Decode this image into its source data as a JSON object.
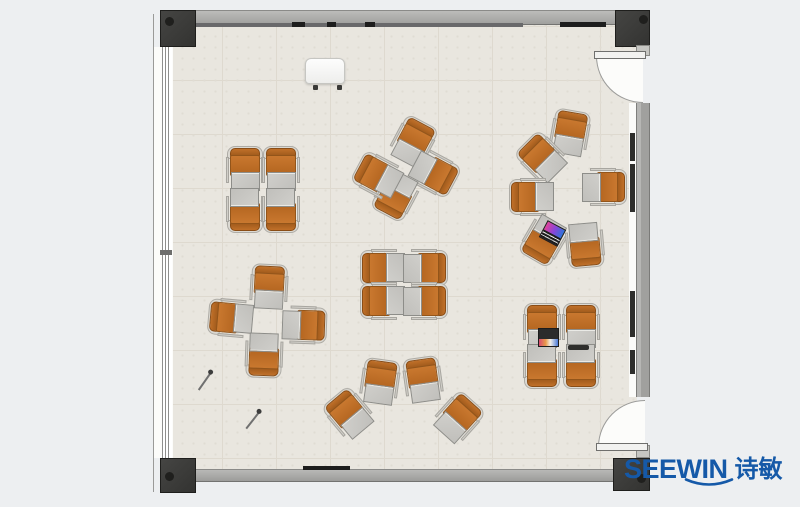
{
  "brand": {
    "name": "SEEWIN",
    "cjk": "诗敏"
  },
  "palette": {
    "brand": "#1559a8",
    "chair": "#c9782f",
    "chair-hi": "#c07029",
    "chair-dark": "#9e591b",
    "desk": "#d0cfcb",
    "wall": "#a6a6a4",
    "column": "#3a3a38",
    "floor": "#e9e6df"
  },
  "plan": {
    "columns": [
      {
        "x": 160,
        "y": 10,
        "w": 36,
        "h": 37,
        "dot": [
          4,
          6
        ]
      },
      {
        "x": 615,
        "y": 10,
        "w": 35,
        "h": 37,
        "dot": [
          23,
          4
        ]
      },
      {
        "x": 160,
        "y": 458,
        "w": 36,
        "h": 35,
        "dot": [
          4,
          13
        ]
      },
      {
        "x": 613,
        "y": 458,
        "w": 37,
        "h": 33,
        "dot": [
          23,
          15
        ]
      }
    ],
    "rwall_pieces": [
      {
        "y": 45,
        "h": 11
      },
      {
        "y": 445,
        "h": 13
      }
    ],
    "wall_boards": [
      {
        "y": 133,
        "h": 28
      },
      {
        "y": 164,
        "h": 48
      },
      {
        "y": 291,
        "h": 46
      },
      {
        "y": 350,
        "h": 24
      }
    ],
    "top_wall_marks": [
      {
        "x": 292,
        "w": 13
      },
      {
        "x": 327,
        "w": 9
      },
      {
        "x": 365,
        "w": 10
      },
      {
        "x": 560,
        "w": 46
      }
    ],
    "bottom_wall_marks": [
      {
        "x": 303,
        "w": 47
      }
    ],
    "doors": [
      {
        "corner": "bl",
        "x": 596,
        "y": 56,
        "size": 47,
        "leaf": [
          594,
          51,
          52,
          8
        ]
      },
      {
        "corner": "tl",
        "x": 598,
        "y": 400,
        "size": 47,
        "leaf": [
          596,
          443,
          52,
          8
        ]
      }
    ],
    "units": [
      {
        "x": 245,
        "y": 169,
        "r": 0
      },
      {
        "x": 281,
        "y": 169,
        "r": 0
      },
      {
        "x": 245,
        "y": 210,
        "r": 180
      },
      {
        "x": 281,
        "y": 210,
        "r": 180
      },
      {
        "x": 413,
        "y": 142,
        "r": 28
      },
      {
        "x": 434,
        "y": 173,
        "r": 118
      },
      {
        "x": 396,
        "y": 195,
        "r": 208
      },
      {
        "x": 378,
        "y": 176,
        "r": 298
      },
      {
        "x": 570,
        "y": 133,
        "r": 10
      },
      {
        "x": 542,
        "y": 158,
        "r": -45
      },
      {
        "x": 532,
        "y": 197,
        "r": -90
      },
      {
        "x": 604,
        "y": 187,
        "r": 90
      },
      {
        "x": 544,
        "y": 240,
        "r": 210
      },
      {
        "x": 585,
        "y": 245,
        "r": 175
      },
      {
        "x": 383,
        "y": 268,
        "r": -90
      },
      {
        "x": 425,
        "y": 268,
        "r": 90
      },
      {
        "x": 383,
        "y": 301,
        "r": -90
      },
      {
        "x": 425,
        "y": 301,
        "r": 90
      },
      {
        "x": 269,
        "y": 287,
        "r": 3
      },
      {
        "x": 231,
        "y": 318,
        "r": -85
      },
      {
        "x": 304,
        "y": 325,
        "r": 92
      },
      {
        "x": 264,
        "y": 355,
        "r": 182
      },
      {
        "x": 349,
        "y": 414,
        "r": -40
      },
      {
        "x": 380,
        "y": 382,
        "r": 8
      },
      {
        "x": 423,
        "y": 380,
        "r": -8
      },
      {
        "x": 458,
        "y": 418,
        "r": 42
      },
      {
        "x": 542,
        "y": 326,
        "r": 0
      },
      {
        "x": 581,
        "y": 326,
        "r": 0
      },
      {
        "x": 542,
        "y": 366,
        "r": 180
      },
      {
        "x": 581,
        "y": 366,
        "r": 180
      }
    ],
    "laptops": [
      {
        "x": 552,
        "y": 233,
        "r": 28,
        "kind": "keyboard-front"
      },
      {
        "x": 548,
        "y": 337,
        "r": 0,
        "kind": "screen-top"
      }
    ],
    "tablet": {
      "x": 568,
      "y": 345,
      "w": 21,
      "h": 5
    },
    "flipchart": {
      "x": 305,
      "y": 58,
      "w": 40,
      "h": 26,
      "feet": [
        [
          7,
          26
        ],
        [
          31,
          26
        ]
      ]
    },
    "pencils": [
      {
        "x": 205,
        "y": 381,
        "r": 35
      },
      {
        "x": 253,
        "y": 420,
        "r": 38
      }
    ]
  }
}
